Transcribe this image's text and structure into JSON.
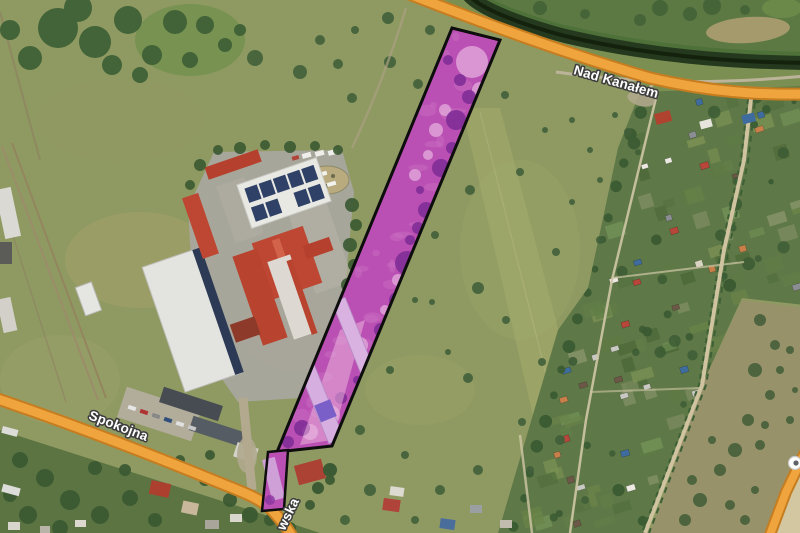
{
  "map": {
    "view_type": "satellite",
    "road_labels": [
      {
        "id": "nad-kanalem",
        "text": "Nad Kanałem"
      },
      {
        "id": "spokojna",
        "text": "Spokojna"
      },
      {
        "id": "wska-partial",
        "text": "wska"
      }
    ],
    "colors": {
      "road_fill": "#f0a43e",
      "road_casing": "#c57d20",
      "parcel_fill": "#bb50b4",
      "parcel_outline": "#0d0d0d",
      "label_text": "#ffffff",
      "label_halo": "#3d3d3d",
      "canal_water": "#24391d",
      "meadow_base": "#8f9a62"
    },
    "parcels": {
      "main_points": "452,28 500,40 332,446 277,452",
      "small_points": "268,452 288,450 284,509 262,511"
    },
    "roads": {
      "nad_kanalem_d": "M 404,-8 C 470,18 560,52 650,78 C 710,92 760,95 808,94",
      "spokojna_d": "M -8,397 C 60,420 140,450 225,485 C 248,494 262,500 272,510 C 280,519 288,528 295,542",
      "side_road_d": "M 810,442 L 786,492 L 768,540"
    },
    "canal": {
      "water_d": "M 468,-6 C 478,8 520,24 565,36 C 650,56 730,62 806,63"
    },
    "scatter": {
      "forest": {
        "fill": "#3f6136",
        "items": [
          [
            58,
            28,
            20
          ],
          [
            95,
            42,
            16
          ],
          [
            128,
            20,
            14
          ],
          [
            30,
            58,
            12
          ],
          [
            152,
            55,
            10
          ],
          [
            175,
            22,
            12
          ],
          [
            112,
            65,
            10
          ],
          [
            78,
            8,
            14
          ],
          [
            10,
            30,
            10
          ],
          [
            140,
            75,
            8
          ],
          [
            190,
            60,
            8
          ],
          [
            205,
            25,
            9
          ],
          [
            225,
            45,
            7
          ],
          [
            240,
            30,
            6
          ]
        ]
      },
      "meadow_trees": {
        "fill": "#41603a",
        "items": [
          [
            390,
            62,
            6
          ],
          [
            418,
            84,
            5
          ],
          [
            352,
            98,
            5
          ],
          [
            300,
            72,
            7
          ],
          [
            255,
            58,
            8
          ],
          [
            338,
            64,
            5
          ],
          [
            470,
            190,
            5
          ],
          [
            520,
            172,
            4
          ],
          [
            478,
            288,
            6
          ],
          [
            506,
            320,
            4
          ],
          [
            468,
            378,
            5
          ],
          [
            522,
            422,
            4
          ],
          [
            478,
            470,
            5
          ],
          [
            432,
            302,
            3
          ],
          [
            448,
            352,
            3
          ],
          [
            556,
            252,
            4
          ],
          [
            572,
            202,
            3
          ],
          [
            542,
            362,
            4
          ],
          [
            600,
            240,
            4
          ],
          [
            435,
            235,
            4
          ],
          [
            415,
            300,
            3
          ],
          [
            390,
            370,
            4
          ],
          [
            360,
            430,
            5
          ],
          [
            405,
            455,
            4
          ],
          [
            440,
            490,
            5
          ],
          [
            370,
            490,
            6
          ],
          [
            345,
            520,
            5
          ],
          [
            415,
            520,
            4
          ],
          [
            600,
            180,
            3
          ],
          [
            628,
            132,
            4
          ],
          [
            590,
            150,
            3
          ],
          [
            420,
            130,
            4
          ],
          [
            460,
            60,
            4
          ],
          [
            430,
            30,
            5
          ],
          [
            388,
            18,
            6
          ],
          [
            355,
            30,
            4
          ],
          [
            320,
            40,
            5
          ],
          [
            615,
            115,
            3
          ],
          [
            572,
            120,
            3
          ],
          [
            505,
            95,
            4
          ],
          [
            545,
            130,
            3
          ],
          [
            560,
            440,
            5
          ],
          [
            530,
            470,
            4
          ],
          [
            585,
            500,
            4
          ]
        ]
      },
      "bottomleft_trees": {
        "fill": "#3c5a33",
        "items": [
          [
            20,
            460,
            8
          ],
          [
            45,
            478,
            9
          ],
          [
            70,
            500,
            10
          ],
          [
            100,
            515,
            9
          ],
          [
            130,
            498,
            8
          ],
          [
            28,
            515,
            9
          ],
          [
            60,
            528,
            8
          ],
          [
            155,
            520,
            7
          ],
          [
            95,
            468,
            7
          ],
          [
            125,
            470,
            6
          ],
          [
            230,
            500,
            7
          ],
          [
            205,
            480,
            6
          ],
          [
            250,
            515,
            8
          ],
          [
            290,
            528,
            6
          ],
          [
            10,
            495,
            7
          ],
          [
            180,
            460,
            5
          ],
          [
            210,
            455,
            5
          ],
          [
            270,
            520,
            6
          ],
          [
            310,
            505,
            5
          ],
          [
            330,
            480,
            5
          ]
        ]
      },
      "hedge_trees": {
        "fill": "#3c5a33",
        "items": [
          [
            352,
            205,
            7
          ],
          [
            356,
            225,
            6
          ],
          [
            350,
            245,
            7
          ],
          [
            354,
            265,
            6
          ],
          [
            348,
            285,
            7
          ],
          [
            352,
            305,
            6
          ],
          [
            346,
            325,
            7
          ],
          [
            350,
            345,
            6
          ],
          [
            344,
            365,
            7
          ],
          [
            348,
            385,
            6
          ],
          [
            240,
            148,
            6
          ],
          [
            265,
            145,
            5
          ],
          [
            290,
            147,
            6
          ],
          [
            315,
            146,
            5
          ],
          [
            218,
            150,
            5
          ],
          [
            200,
            165,
            6
          ],
          [
            190,
            185,
            5
          ],
          [
            338,
            150,
            5
          ]
        ]
      },
      "scrub_bushes": {
        "fill": "#45603a",
        "items": [
          [
            760,
            320,
            6
          ],
          [
            775,
            345,
            5
          ],
          [
            755,
            370,
            7
          ],
          [
            770,
            395,
            5
          ],
          [
            748,
            420,
            6
          ],
          [
            735,
            450,
            7
          ],
          [
            760,
            445,
            5
          ],
          [
            720,
            470,
            6
          ],
          [
            700,
            500,
            7
          ],
          [
            730,
            505,
            5
          ],
          [
            685,
            520,
            6
          ],
          [
            790,
            420,
            4
          ],
          [
            780,
            370,
            4
          ],
          [
            795,
            390,
            3
          ],
          [
            712,
            440,
            4
          ],
          [
            692,
            480,
            5
          ],
          [
            755,
            490,
            4
          ],
          [
            745,
            520,
            5
          ],
          [
            790,
            350,
            4
          ],
          [
            765,
            425,
            4
          ]
        ]
      },
      "canal_top_trees": {
        "fill": "#406035",
        "items": [
          [
            660,
            8,
            8
          ],
          [
            690,
            14,
            7
          ],
          [
            712,
            6,
            9
          ],
          [
            745,
            10,
            5
          ],
          [
            640,
            20,
            6
          ],
          [
            540,
            8,
            7
          ],
          [
            585,
            14,
            5
          ]
        ]
      },
      "parcel_dark_blobs": {
        "fill": "#7d2b96",
        "items": [
          [
            456,
            120,
            10
          ],
          [
            469,
            97,
            7
          ],
          [
            441,
            168,
            9
          ],
          [
            452,
            148,
            6
          ],
          [
            426,
            210,
            8
          ],
          [
            431,
            242,
            10
          ],
          [
            407,
            263,
            12
          ],
          [
            397,
            300,
            8
          ],
          [
            381,
            330,
            7
          ],
          [
            341,
            398,
            6
          ],
          [
            302,
            428,
            8
          ],
          [
            418,
            228,
            6
          ],
          [
            390,
            315,
            5
          ],
          [
            460,
            80,
            6
          ],
          [
            448,
            60,
            5
          ],
          [
            463,
            180,
            5
          ],
          [
            420,
            190,
            4
          ],
          [
            410,
            240,
            5
          ],
          [
            370,
            360,
            5
          ],
          [
            357,
            380,
            4
          ],
          [
            288,
            442,
            6
          ]
        ]
      },
      "parcel_light_blobs": {
        "fill": "#e2a8da",
        "items": [
          [
            472,
            62,
            16
          ],
          [
            480,
            90,
            8
          ],
          [
            436,
            130,
            7
          ],
          [
            398,
            280,
            6
          ],
          [
            360,
            345,
            8
          ],
          [
            330,
            415,
            10
          ],
          [
            310,
            432,
            8
          ],
          [
            415,
            175,
            6
          ],
          [
            428,
            155,
            5
          ],
          [
            445,
            110,
            6
          ],
          [
            385,
            310,
            5
          ]
        ]
      }
    },
    "poi": {
      "type": "stop-marker"
    }
  }
}
